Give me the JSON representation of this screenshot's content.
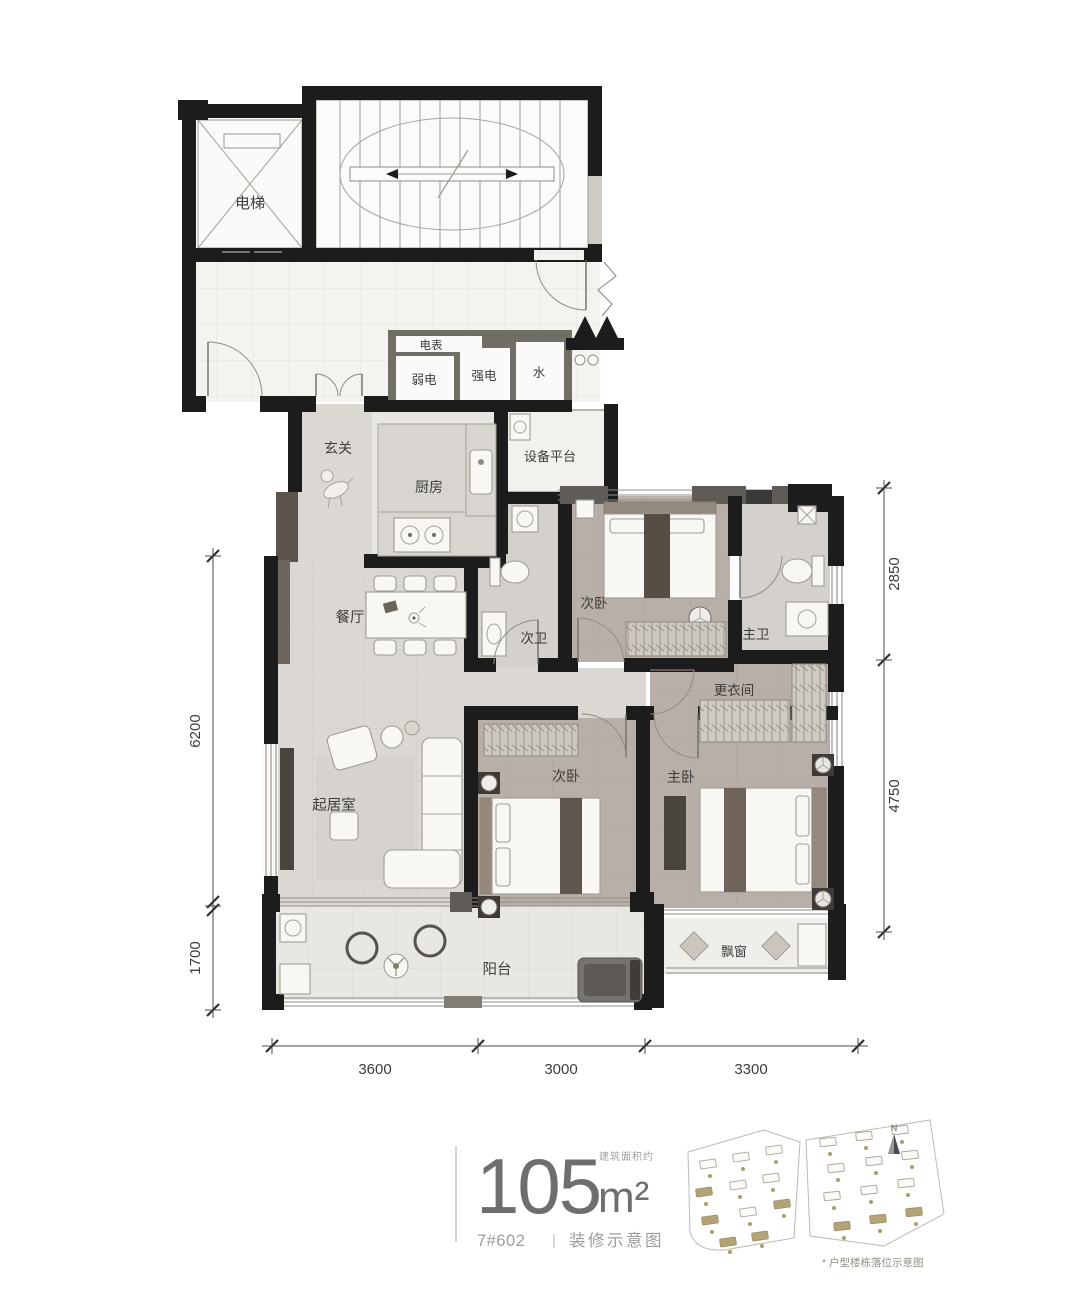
{
  "plan": {
    "rooms": {
      "elevator": "电梯",
      "meter": "电表",
      "weak_elec": "弱电",
      "strong_elec": "强电",
      "water": "水",
      "entry": "玄关",
      "kitchen": "厨房",
      "equip_platform": "设备平台",
      "dining": "餐厅",
      "bath2": "次卫",
      "bedroom2_top": "次卧",
      "master_bath": "主卫",
      "closet": "更衣间",
      "living": "起居室",
      "bedroom2": "次卧",
      "master_bedroom": "主卧",
      "balcony": "阳台",
      "bay_window": "飘窗"
    },
    "dimensions": {
      "left": [
        "6200",
        "1700"
      ],
      "right": [
        "2850",
        "4750"
      ],
      "bottom": [
        "3600",
        "3000",
        "3300"
      ]
    }
  },
  "footer": {
    "area_prefix": "建筑面积约",
    "area_value": "105",
    "area_unit": "m²",
    "unit_no": "7#602",
    "separator": "|",
    "caption": "装修示意图",
    "site_note": "* 户型楼栋落位示意图",
    "north_label": "N"
  },
  "colors": {
    "wall": "#1c1c1c",
    "floor_public": "#f4f3f0",
    "floor_living": "#dbd7d2",
    "floor_bedroom": "#b8b0a8",
    "floor_bath": "#d4d1cc",
    "floor_balcony": "#e9e7e2",
    "accent_dark_furniture": "#4a443e",
    "site_highlight": "#b3a478",
    "text_gray": "#9b9b9b"
  }
}
